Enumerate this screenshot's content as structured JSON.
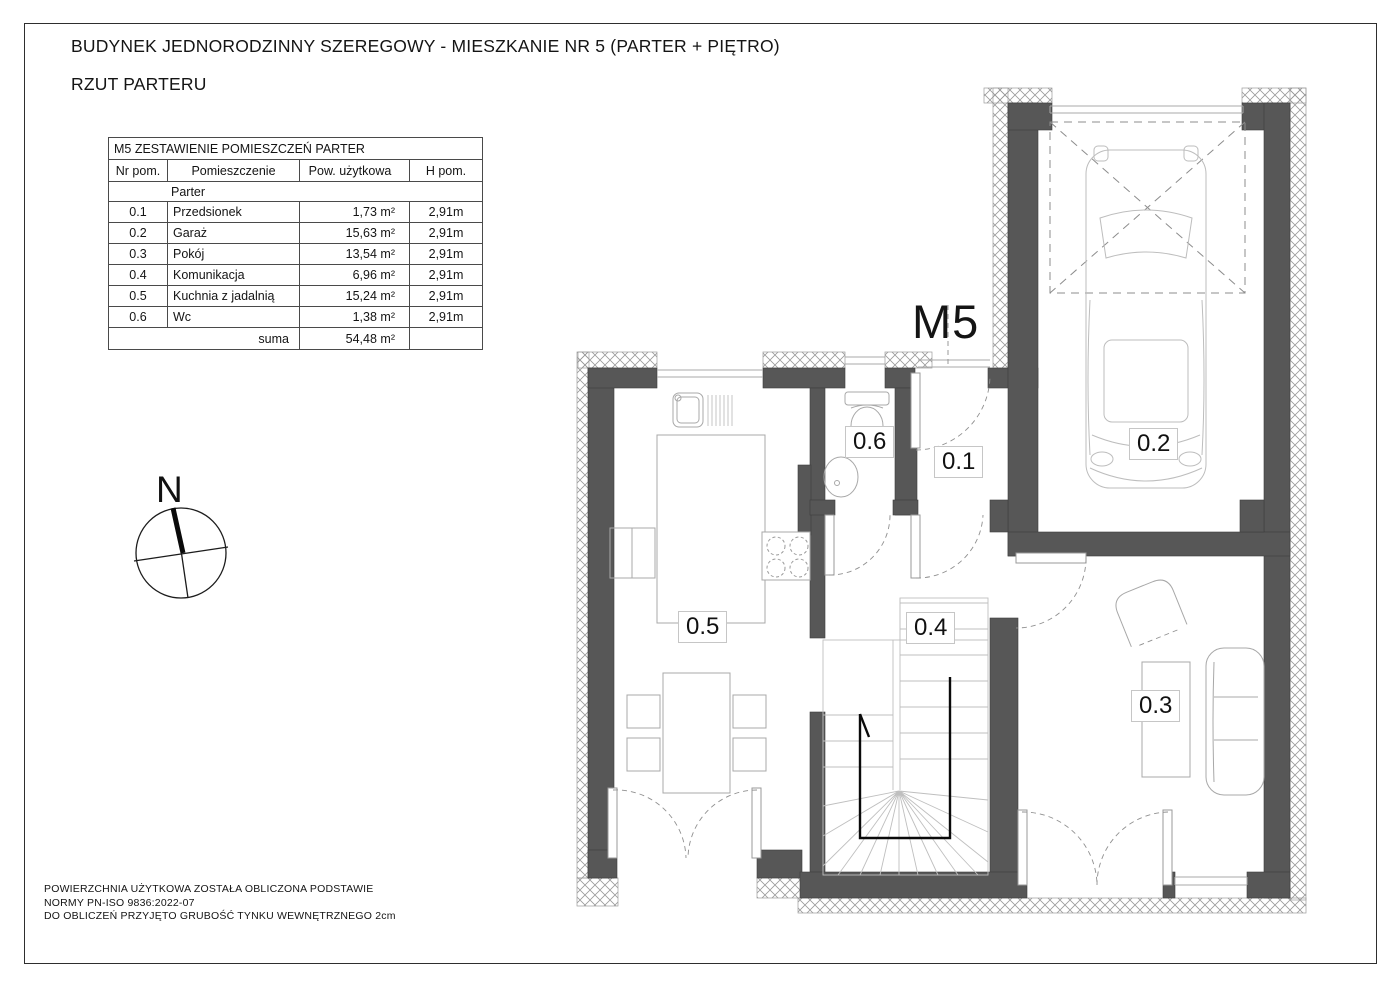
{
  "page": {
    "title_line1": "BUDYNEK JEDNORODZINNY SZEREGOWY - MIESZKANIE NR 5 (PARTER + PIĘTRO)",
    "title_line2": "RZUT PARTERU",
    "footer_lines": [
      "POWIERZCHNIA UŻYTKOWA ZOSTAŁA OBLICZONA PODSTAWIE",
      "NORMY PN-ISO 9836:2022-07",
      "DO OBLICZEŃ PRZYJĘTO GRUBOŚĆ TYNKU WEWNĘTRZNEGO 2cm"
    ]
  },
  "table": {
    "title": "M5 ZESTAWIENIE POMIESZCZEŃ PARTER",
    "headers": [
      "Nr pom.",
      "Pomieszczenie",
      "Pow. użytkowa",
      "H pom."
    ],
    "section": "Parter",
    "rows": [
      {
        "nr": "0.1",
        "name": "Przedsionek",
        "area": "1,73 m²",
        "h": "2,91m"
      },
      {
        "nr": "0.2",
        "name": "Garaż",
        "area": "15,63 m²",
        "h": "2,91m"
      },
      {
        "nr": "0.3",
        "name": "Pokój",
        "area": "13,54 m²",
        "h": "2,91m"
      },
      {
        "nr": "0.4",
        "name": "Komunikacja",
        "area": "6,96 m²",
        "h": "2,91m"
      },
      {
        "nr": "0.5",
        "name": "Kuchnia z jadalnią",
        "area": "15,24 m²",
        "h": "2,91m"
      },
      {
        "nr": "0.6",
        "name": "Wc",
        "area": "1,38 m²",
        "h": "2,91m"
      }
    ],
    "sum_label": "suma",
    "sum_area": "54,48 m²"
  },
  "plan": {
    "unit_label": "M5",
    "north_label": "N",
    "room_labels": [
      "0.1",
      "0.2",
      "0.3",
      "0.4",
      "0.5",
      "0.6"
    ],
    "colors": {
      "wall": "#575757",
      "hatch": "#9b9b9b",
      "thin": "#a8a8a8",
      "dash": "#909090",
      "text": "#141414",
      "stair_cut": "#0a0a0a",
      "label_border": "#c6c6c6"
    }
  }
}
